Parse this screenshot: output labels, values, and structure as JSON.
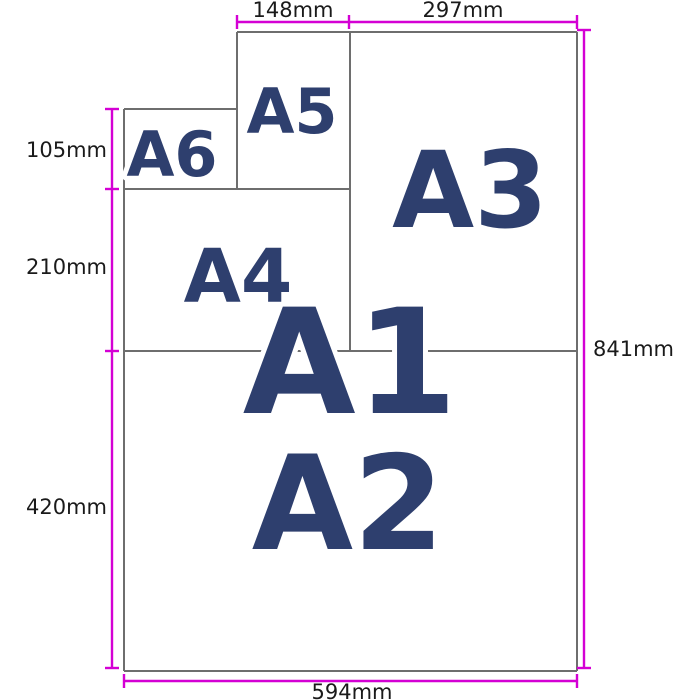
{
  "papers": [
    {
      "label": "A1"
    },
    {
      "label": "A2"
    },
    {
      "label": "A3"
    },
    {
      "label": "A4"
    },
    {
      "label": "A5"
    },
    {
      "label": "A6"
    }
  ],
  "dimensions": {
    "top": [
      "148mm",
      "297mm"
    ],
    "left": [
      "105mm",
      "210mm",
      "420mm"
    ],
    "right": [
      "841mm"
    ],
    "bottom": [
      "594mm"
    ]
  },
  "colors": {
    "dimension_line": "#d400d4",
    "sheet_outline": "#6e6e6e",
    "paper_label": "#2e3f6e",
    "measurement_text": "#1a1a1a"
  }
}
